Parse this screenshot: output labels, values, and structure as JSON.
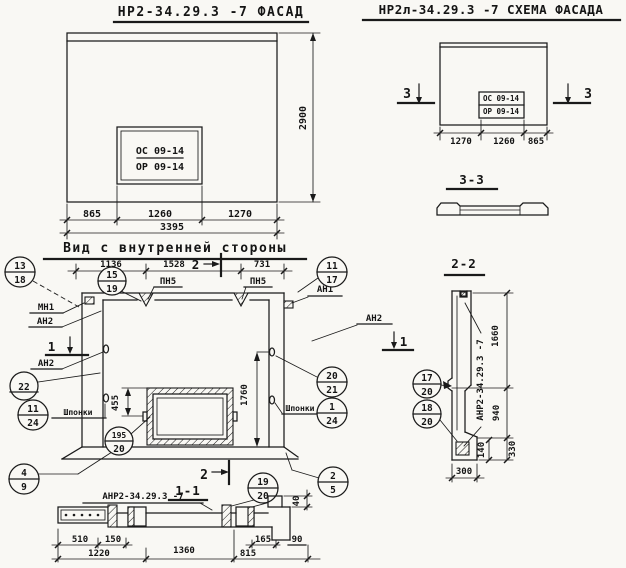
{
  "colors": {
    "paper": "#f9f8f4",
    "ink": "#1a1a1a"
  },
  "facade": {
    "title": "НР2-34.29.3 -7 ФАСАД",
    "opening_mark_top": "ОС 09-14",
    "opening_mark_bot": "ОР 09-14",
    "dim_left": "865",
    "dim_mid": "1260",
    "dim_right": "1270",
    "dim_total": "3395",
    "dim_height": "2900"
  },
  "schema": {
    "title": "НР2л-34.29.3 -7 СХЕМА ФАСАДА",
    "opening_mark_top": "ОС 09-14",
    "opening_mark_bot": "ОР 09-14",
    "dim_left": "1270",
    "dim_mid": "1260",
    "dim_right": "865",
    "section_mark": "3"
  },
  "section33": {
    "title": "3-3"
  },
  "inner": {
    "title": "Вид с внутренней стороны",
    "dim_a": "1136",
    "dim_b": "1528",
    "dim_c": "731",
    "dim_win": "455",
    "dim_height": "1760",
    "dim_lip": "40",
    "pn5": "ПН5",
    "mn1": "МН1",
    "an1": "АН1",
    "an2": "АН2",
    "shponki": "Шпонки",
    "mark1": "1",
    "mark2": "2"
  },
  "callouts": {
    "c13_18": {
      "top": "13",
      "bot": "18"
    },
    "c15_19": {
      "top": "15",
      "bot": "19"
    },
    "c11_17": {
      "top": "11",
      "bot": "17"
    },
    "c22": {
      "top": "22"
    },
    "c11_24": {
      "top": "11",
      "bot": "24"
    },
    "c195_20": {
      "top": "195",
      "bot": "20"
    },
    "c20_21": {
      "top": "20",
      "bot": "21"
    },
    "c1_24": {
      "top": "1",
      "bot": "24"
    },
    "c4_9": {
      "top": "4",
      "bot": "9"
    },
    "c19_20": {
      "top": "19",
      "bot": "20"
    },
    "c2_5": {
      "top": "2",
      "bot": "5"
    },
    "c17_20": {
      "top": "17",
      "bot": "20"
    },
    "c18_20": {
      "top": "18",
      "bot": "20"
    }
  },
  "section11": {
    "title": "1-1",
    "label": "АНР2-34.29.3 -7",
    "d510": "510",
    "d150": "150",
    "d1220": "1220",
    "d1360": "1360",
    "d165": "165",
    "d815": "815",
    "d90": "90"
  },
  "section22": {
    "title": "2-2",
    "label": "АНР2-34.29.3 -7",
    "d1660": "1660",
    "d940": "940",
    "d330": "330",
    "d140": "140",
    "d300": "300"
  }
}
